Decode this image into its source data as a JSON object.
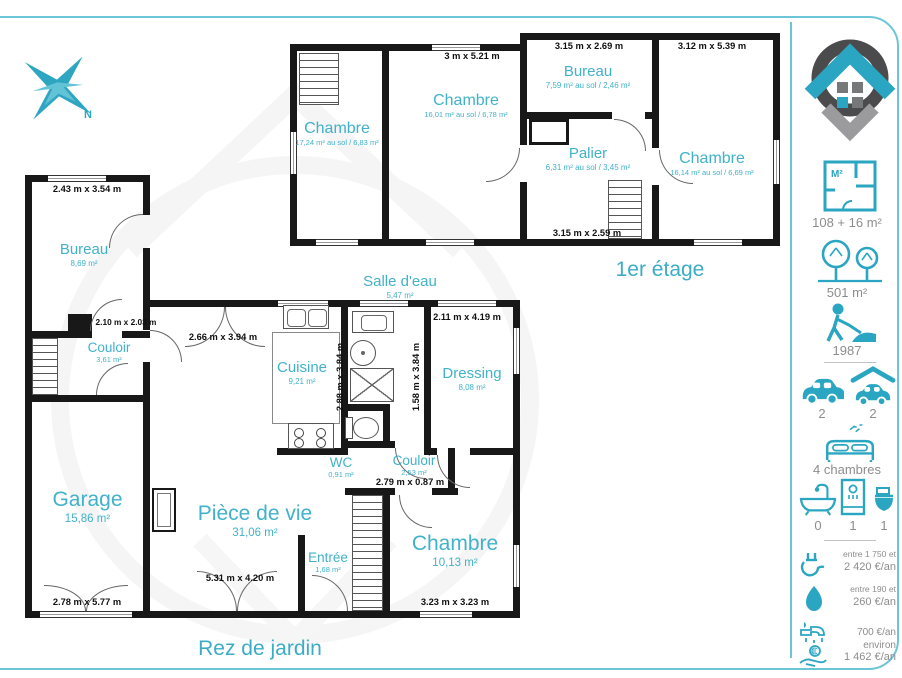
{
  "meta": {
    "compass_label": "N"
  },
  "colors": {
    "accent": "#2ba6c2",
    "label_teal": "#41b2ca",
    "wall": "#181818",
    "grey_text": "#8d8d8f",
    "border_teal": "#6cc6d8"
  },
  "floor1": {
    "title": "1er étage",
    "rooms": {
      "chambre_left": {
        "name": "Chambre",
        "area": "17,24 m² au sol / 6,83 m²"
      },
      "chambre_mid": {
        "name": "Chambre",
        "area": "16,01 m² au sol / 6,78 m²"
      },
      "bureau": {
        "name": "Bureau",
        "area": "7,59 m² au sol / 2,46 m²"
      },
      "palier": {
        "name": "Palier",
        "area": "6,31 m² au sol / 3,45 m²"
      },
      "chambre_right": {
        "name": "Chambre",
        "area": "16,14 m² au sol / 6,69 m²"
      }
    },
    "dims": {
      "mid_top": "3 m x 5.21 m",
      "bureau_top": "3.15 m x 2.69 m",
      "chambre_right_top": "3.12 m x 5.39 m",
      "palier_bottom": "3.15 m x 2.59 m"
    }
  },
  "floor0": {
    "title": "Rez de jardin",
    "rooms": {
      "bureau": {
        "name": "Bureau",
        "area": "8,69 m²"
      },
      "couloir": {
        "name": "Couloir",
        "area": "3,61 m²"
      },
      "garage": {
        "name": "Garage",
        "area": "15,86 m²"
      },
      "piece_de_vie": {
        "name": "Pièce de vie",
        "area": "31,06 m²"
      },
      "cuisine": {
        "name": "Cuisine",
        "area": "9,21 m²"
      },
      "salle_eau": {
        "name": "Salle d'eau",
        "area": "5,47 m²"
      },
      "dressing": {
        "name": "Dressing",
        "area": "8,08 m²"
      },
      "wc": {
        "name": "WC",
        "area": "0,91 m²"
      },
      "couloir2": {
        "name": "Couloir",
        "area": "2,53 m²"
      },
      "entree": {
        "name": "Entrée",
        "area": "1,68 m²"
      },
      "chambre": {
        "name": "Chambre",
        "area": "10,13 m²"
      }
    },
    "dims": {
      "bureau_top": "2.43 m x 3.54 m",
      "couloir": "2.10 m x 2.03 m",
      "garage_bottom": "2.78 m x 5.77 m",
      "piece_top": "2.66 m x 3.94 m",
      "piece_bottom": "5.31 m x 4.20 m",
      "cuisine_v": "2.88 m x 3.84 m",
      "dressing_v": "1.58 m x 3.84 m",
      "dressing_top": "2.11 m x 4.19 m",
      "couloir2": "2.79 m x 0.87 m",
      "chambre_bottom": "3.23 m x 3.23 m"
    }
  },
  "sidebar": {
    "plan_icon_label": "M²",
    "surface": "108 + 16 m²",
    "land": "501 m²",
    "year": "1987",
    "parking": "2",
    "garage": "2",
    "bedrooms": "4 chambres",
    "bathtubs": "0",
    "showers": "1",
    "toilets": "1",
    "electricity_line1": "entre 1 750 et",
    "electricity_line2": "2 420 €/an",
    "gas_line1": "entre 190 et",
    "gas_line2": "260 €/an",
    "water": "700 €/an environ",
    "tax": "1 462 €/an"
  }
}
